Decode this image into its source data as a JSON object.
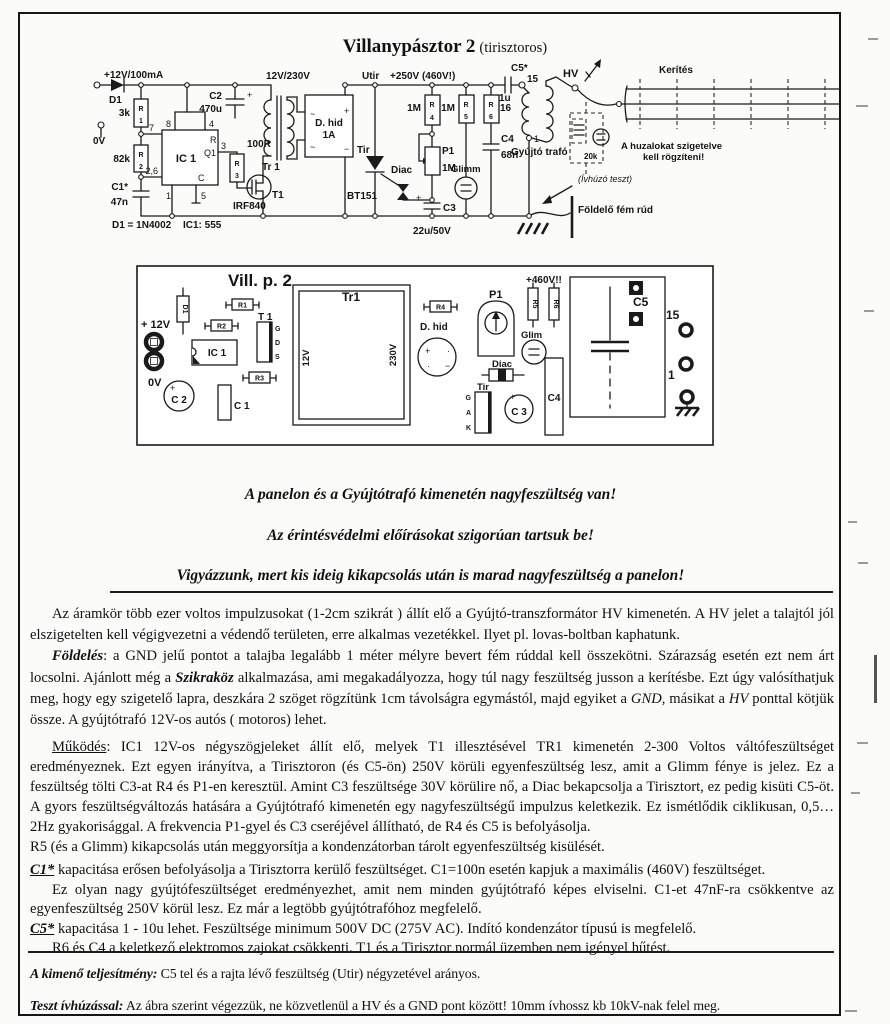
{
  "doc": {
    "title_main": "Villanypásztor 2",
    "title_sub": "(tirisztoros)"
  },
  "schematic": {
    "supply": "+12V/100mA",
    "d1": "D1",
    "d1_type": "D1 = 1N4002",
    "ic_type": "IC1: 555",
    "rletter": "R",
    "n1": "1",
    "n2": "2",
    "n3": "3",
    "n4": "4",
    "n5": "5",
    "n6": "6",
    "n7": "7",
    "n8": "8",
    "p26": "2,6",
    "v3k": "3k",
    "v82k": "82k",
    "c1": "C1*",
    "c1v": "47n",
    "zerov": "0V",
    "ic1": "IC 1",
    "pq": "Q1",
    "pc": "C",
    "c2": "C2",
    "c2v": "470u",
    "v100r": "100R",
    "t1": "T1",
    "t1type": "IRF840",
    "ratio": "12V/230V",
    "tr1": "Tr 1",
    "bridge": "D. hid",
    "bridge_a": "1A",
    "tilde": "~",
    "plus": "+",
    "minus": "−",
    "utir": "Utir",
    "railv": "+250V (460V!)",
    "tir": "Tir",
    "tirtype": "BT151",
    "diac": "Diac",
    "v1m": "1M",
    "v16": "16",
    "p1": "P1",
    "c3": "C3",
    "c3v": "22u/50V",
    "glimm": "Glimm",
    "c4": "C4",
    "c4v": "68n",
    "c5": "C5*",
    "c5v": "1u",
    "t15": "15",
    "gytr": "Gyújtó trafó",
    "hv": "HV",
    "ker": "Kerítés",
    "ins1": "A huzalokat szigetelve",
    "ins2": "kell rögzíteni!",
    "v20k": "20k",
    "ivh": "(Ívhúzó teszt)",
    "fold": "Földelő fém rúd"
  },
  "pcb": {
    "title": "Vill. p. 2",
    "d1": "D1",
    "p12": "+ 12V",
    "zerov": "0V",
    "c2": "C 2",
    "ic1": "IC 1",
    "c1": "C 1",
    "r1": "R1",
    "r2": "R2",
    "r3": "R3",
    "r4": "R4",
    "r5": "R5",
    "r6": "R6",
    "t1": "T 1",
    "g": "G",
    "d": "D",
    "s": "S",
    "tr1": "Tr1",
    "v12": "12V",
    "v230": "230V",
    "dhid": "D. hid",
    "p1": "P1",
    "v460": "+460V!!",
    "glim": "Glim",
    "diac": "Diac",
    "tir": "Tir",
    "a": "A",
    "k": "K",
    "c3": "C 3",
    "c4": "C4",
    "c5": "C5",
    "p15": "15",
    "pn1": "1",
    "plus": "+",
    "minus": "−",
    "dot": "·"
  },
  "warnings": {
    "w1": "A panelon és a Gyújtótrafó kimenetén nagyfeszültség van!",
    "w2": "Az érintésvédelmi előírásokat szigorúan tartsuk be!",
    "w3": "Vigyázzunk, mert kis ideig kikapcsolás után is marad nagyfeszültség a panelon!"
  },
  "body": {
    "p1a": [
      {
        "t": "Az áramkör több ezer voltos impulzusokat (1-2cm szikrát ) állít elő a Gyújtó-transzformátor HV kimenetén. A HV jelet a talajtól jól elszigetelten kell végigvezetni a védendő területen, erre alkalmas vezetékkel. Ilyet pl. lovas-boltban kaphatunk."
      }
    ],
    "p1b": [
      {
        "t": "Földelés",
        "s": "bi"
      },
      {
        "t": ":  a GND jelű pontot a talajba legalább 1 méter mélyre bevert fém rúddal kell összekötni. Szárazság esetén ezt nem árt locsolni.  Ajánlott még a "
      },
      {
        "t": "Szikraköz",
        "s": "bi"
      },
      {
        "t": " alkalmazása, ami megakadályozza, hogy túl nagy feszültség jusson a kerítésbe. Ezt úgy valósíthatjuk meg, hogy egy szigetelő lapra, deszkára 2 szöget rögzítünk 1cm távolságra egymástól, majd egyiket a "
      },
      {
        "t": "GND",
        "s": "it"
      },
      {
        "t": ", másikat a "
      },
      {
        "t": "HV",
        "s": "it"
      },
      {
        "t": " ponttal kötjük össze.  A gyújtótrafó 12V-os autós ( motoros) lehet."
      }
    ],
    "p2a": [
      {
        "t": "Működés",
        "s": "un"
      },
      {
        "t": ": IC1 12V-os négyszögjeleket állít elő, melyek T1 illesztésével TR1 kimenetén 2-300 Voltos váltófeszültséget eredményeznek.  Ezt egyen irányítva, a Tirisztoron (és C5-ön) 250V körüli egyenfeszültség lesz, amit a Glimm fénye is jelez. Ez a feszültség tölti C3-at R4 és P1-en keresztül. Amint C3 feszültsége 30V körülire nő, a Diac bekapcsolja a Tirisztort, ez pedig kisüti C5-öt. A gyors feszültségváltozás hatására a Gyújtótrafó kimenetén egy nagyfeszültségű impulzus keletkezik. Ez ismétlődik ciklikusan, 0,5…2Hz gyakorisággal. A frekvencia P1-gyel és C3 cseréjével állítható, de R4 és C5 is befolyásolja."
      }
    ],
    "p2b": [
      {
        "t": "R5 (és a Glimm) kikapcsolás után meggyorsítja a kondenzátorban tárolt egyenfeszültség kisülését."
      }
    ],
    "p3a": [
      {
        "t": "C1*",
        "s": "bi un"
      },
      {
        "t": " kapacitása erősen befolyásolja a Tirisztorra kerülő feszültséget. C1=100n esetén kapjuk a maximális (460V) feszültséget."
      }
    ],
    "p3b": [
      {
        "t": "Ez olyan nagy gyújtófeszültséget eredményezhet, amit nem minden gyújtótrafó képes elviselni.  C1-et 47nF-ra csökkentve az egyenfeszültség 250V  körül lesz. Ez már a legtöbb gyújtótrafóhoz megfelelő."
      }
    ],
    "p3c": [
      {
        "t": "C5*",
        "s": "bi un"
      },
      {
        "t": "  kapacitása 1 - 10u lehet. Feszültsége minimum 500V DC (275V AC). Indító kondenzátor típusú is megfelelő."
      }
    ],
    "p3d": [
      {
        "t": "R6 és C4 a keletkező elektromos zajokat csökkenti.  T1 és a Tirisztor normál üzemben nem igényel hűtést."
      }
    ],
    "p4": [
      {
        "t": "A kimenő teljesítmény:",
        "s": "bi"
      },
      {
        "t": "  C5 tel és a rajta lévő feszültség (Utir) négyzetével arányos."
      }
    ],
    "p5": [
      {
        "t": "Teszt ívhúzással:",
        "s": "bi"
      },
      {
        "t": " Az ábra szerint végezzük, ne közvetlenül a HV és a GND pont között!  10mm ívhossz kb 10kV-nak felel meg."
      }
    ]
  }
}
